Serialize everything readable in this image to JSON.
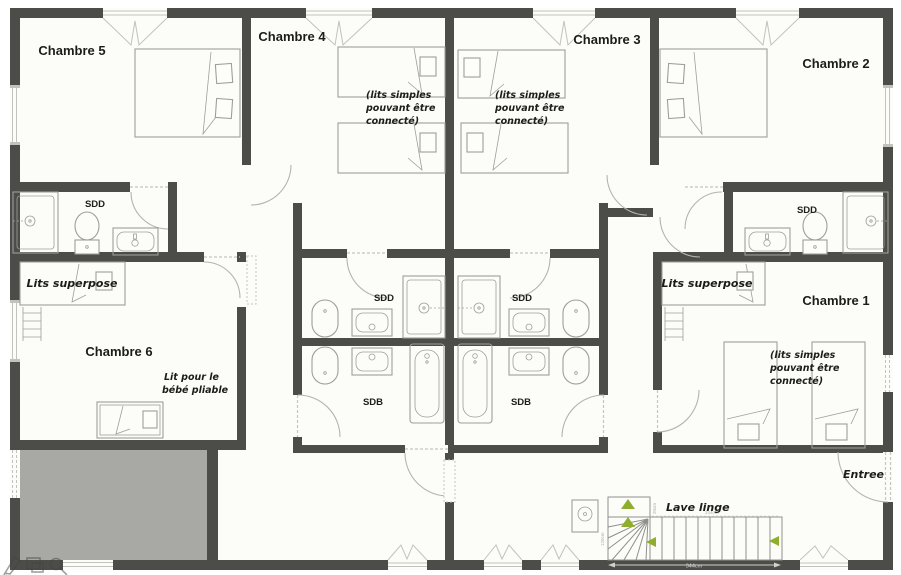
{
  "plan": {
    "type": "floor-plan",
    "room_labels": {
      "c1": "Chambre 1",
      "c2": "Chambre 2",
      "c3": "Chambre 3",
      "c4": "Chambre 4",
      "c5": "Chambre 5",
      "c6": "Chambre 6"
    },
    "fixture_labels": {
      "sdd": "SDD",
      "sdb": "SDB"
    },
    "annotations": {
      "bunk_bed": "Lits superpose",
      "twin_note": [
        "(lits simples",
        "pouvant être",
        "connecté)"
      ],
      "baby_note": [
        "Lit pour le",
        "bébé pliable"
      ],
      "entrance": "Entree",
      "washer": "Lave linge"
    },
    "dimensions": {
      "stair_total": "344cm",
      "stair_run": "244cm",
      "winder_height": "120cm",
      "winder_offset": "20cm"
    },
    "colors": {
      "wall": "#4c4c48",
      "void_fill": "#a8a8a4",
      "arrow_green": "#8fae2c",
      "text": "#1c1c1a",
      "fixture_line": "#9e9e9a"
    },
    "watermark_icons": [
      "pencil-icon",
      "frames-icon",
      "magnifier-icon"
    ]
  }
}
